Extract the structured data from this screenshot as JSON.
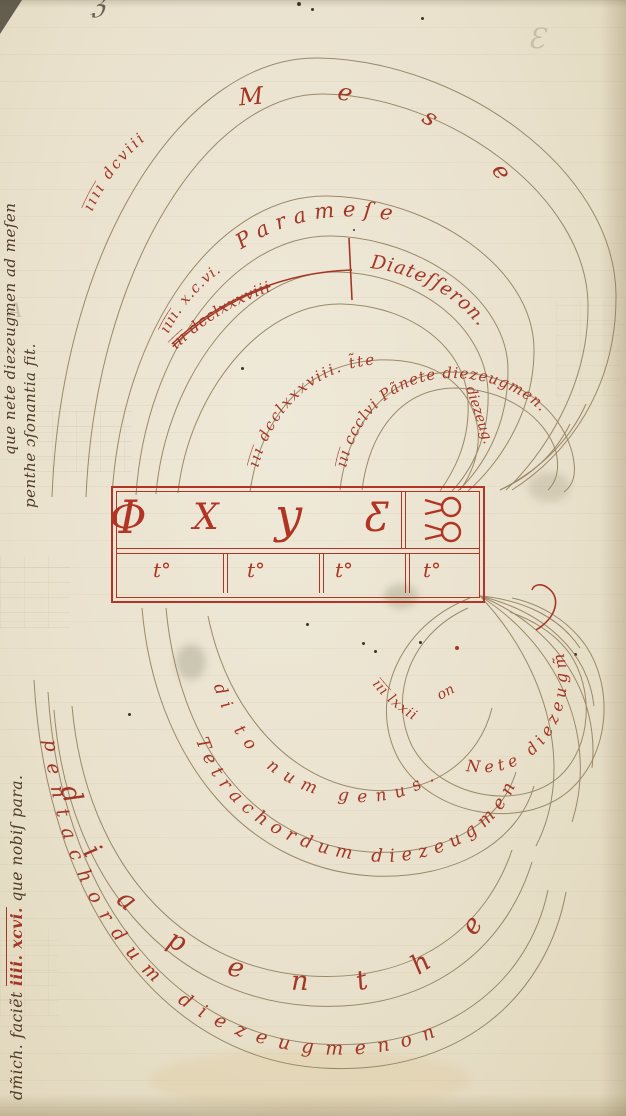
{
  "page": {
    "parchment_color": "#e9e1cc",
    "red_ink": "#a33626",
    "table_red": "#b13425",
    "arc_line_brown": "#8f7d5b",
    "margin_ink": "#4e3b28"
  },
  "margin_notes": {
    "upper_line1": "que nete diezeugmen ad meſen",
    "upper_line2": "penthe ɔſonantia fit.",
    "lower_prefix": "dm̃ich. faciẽt",
    "lower_number": "iiii. xcvi.",
    "lower_suffix": "que nobiſ para."
  },
  "upper_arcs": {
    "mese_number": "i̅i̅i̅i̅ dcviii",
    "mese_letters": "Mese",
    "paramese_number": "i̅i̅i̅i̅. x.c.vi.",
    "paramese_label": "Parameſe",
    "struck_number": "i̅i̅i̅ dcclxxxviii",
    "diatesseron_label": "Diateſſeron.",
    "trite_text": "i̅i̅i̅ dcclxxxviii. t̃te",
    "trite_radial": "diezeug.",
    "paranete_text": "i̅i̅i̅ ccclvi Pãnete diezeugmen."
  },
  "lower_arcs": {
    "nete_number": "i̅i̅i̅ lxxii",
    "nete_label": "Nete diezeugm̃",
    "fragment_on": "on",
    "genus_label": "di to num genus.",
    "tetrachord_label": "Tetrachordum diezeugmen",
    "diapente_letters": "diapenthe",
    "pentachord_label": "pentachordum diezeugmenon"
  },
  "table": {
    "note_symbols": [
      "Φ",
      "X",
      "y",
      "Ƹ"
    ],
    "interval_cells": [
      "t°",
      "t°",
      "t°",
      "t°"
    ]
  },
  "bleedthrough": {
    "glyph_top_right": "Ɛ",
    "glyph_top_edge": "ℨ",
    "glyph_left": "A"
  }
}
